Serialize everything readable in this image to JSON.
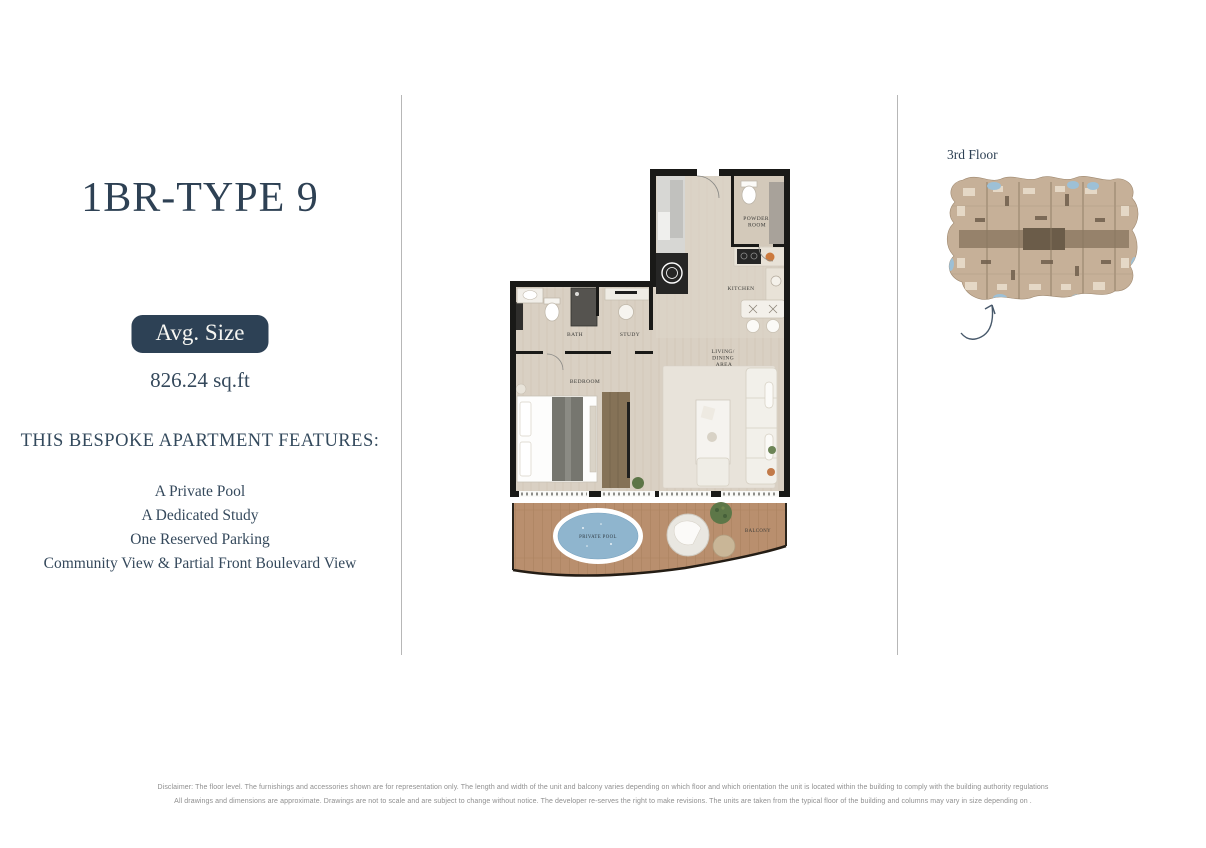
{
  "colors": {
    "accent": "#2e4154",
    "badge_bg": "#2d4155",
    "pool": "#8fb5ce",
    "balcony_wood": "#b98f6e"
  },
  "left_panel": {
    "title": "1BR-TYPE 9",
    "avg_size_label": "Avg. Size",
    "avg_size_value": "826.24 sq.ft",
    "features_heading": "THIS BESPOKE APARTMENT FEATURES:",
    "features": [
      "A Private Pool",
      "A Dedicated Study",
      "One Reserved Parking",
      "Community View & Partial Front Boulevard View"
    ]
  },
  "floor_plan": {
    "labels": {
      "powder": [
        "POWDER",
        "ROOM"
      ],
      "kitchen": "KITCHEN",
      "living": [
        "LIVING/",
        "DINING",
        "AREA"
      ],
      "bath": "BATH",
      "study": "STUDY",
      "bedroom": "BEDROOM",
      "pool": "PRIVATE POOL",
      "balcony": "BALCONY"
    }
  },
  "key_plan": {
    "floor_label": "3rd Floor"
  },
  "disclaimer": {
    "line1": "Disclaimer: The floor level. The furnishings and accessories shown are for representation only. The length and width of the unit and balcony varies depending on which floor and which orientation the unit is located within the building to comply with the building authority regulations",
    "line2": "All drawings and dimensions are approximate. Drawings are not to scale and are subject to change without notice. The developer re-serves the right to make revisions. The units are taken from the typical floor of the building and columns may vary in size depending on ."
  }
}
